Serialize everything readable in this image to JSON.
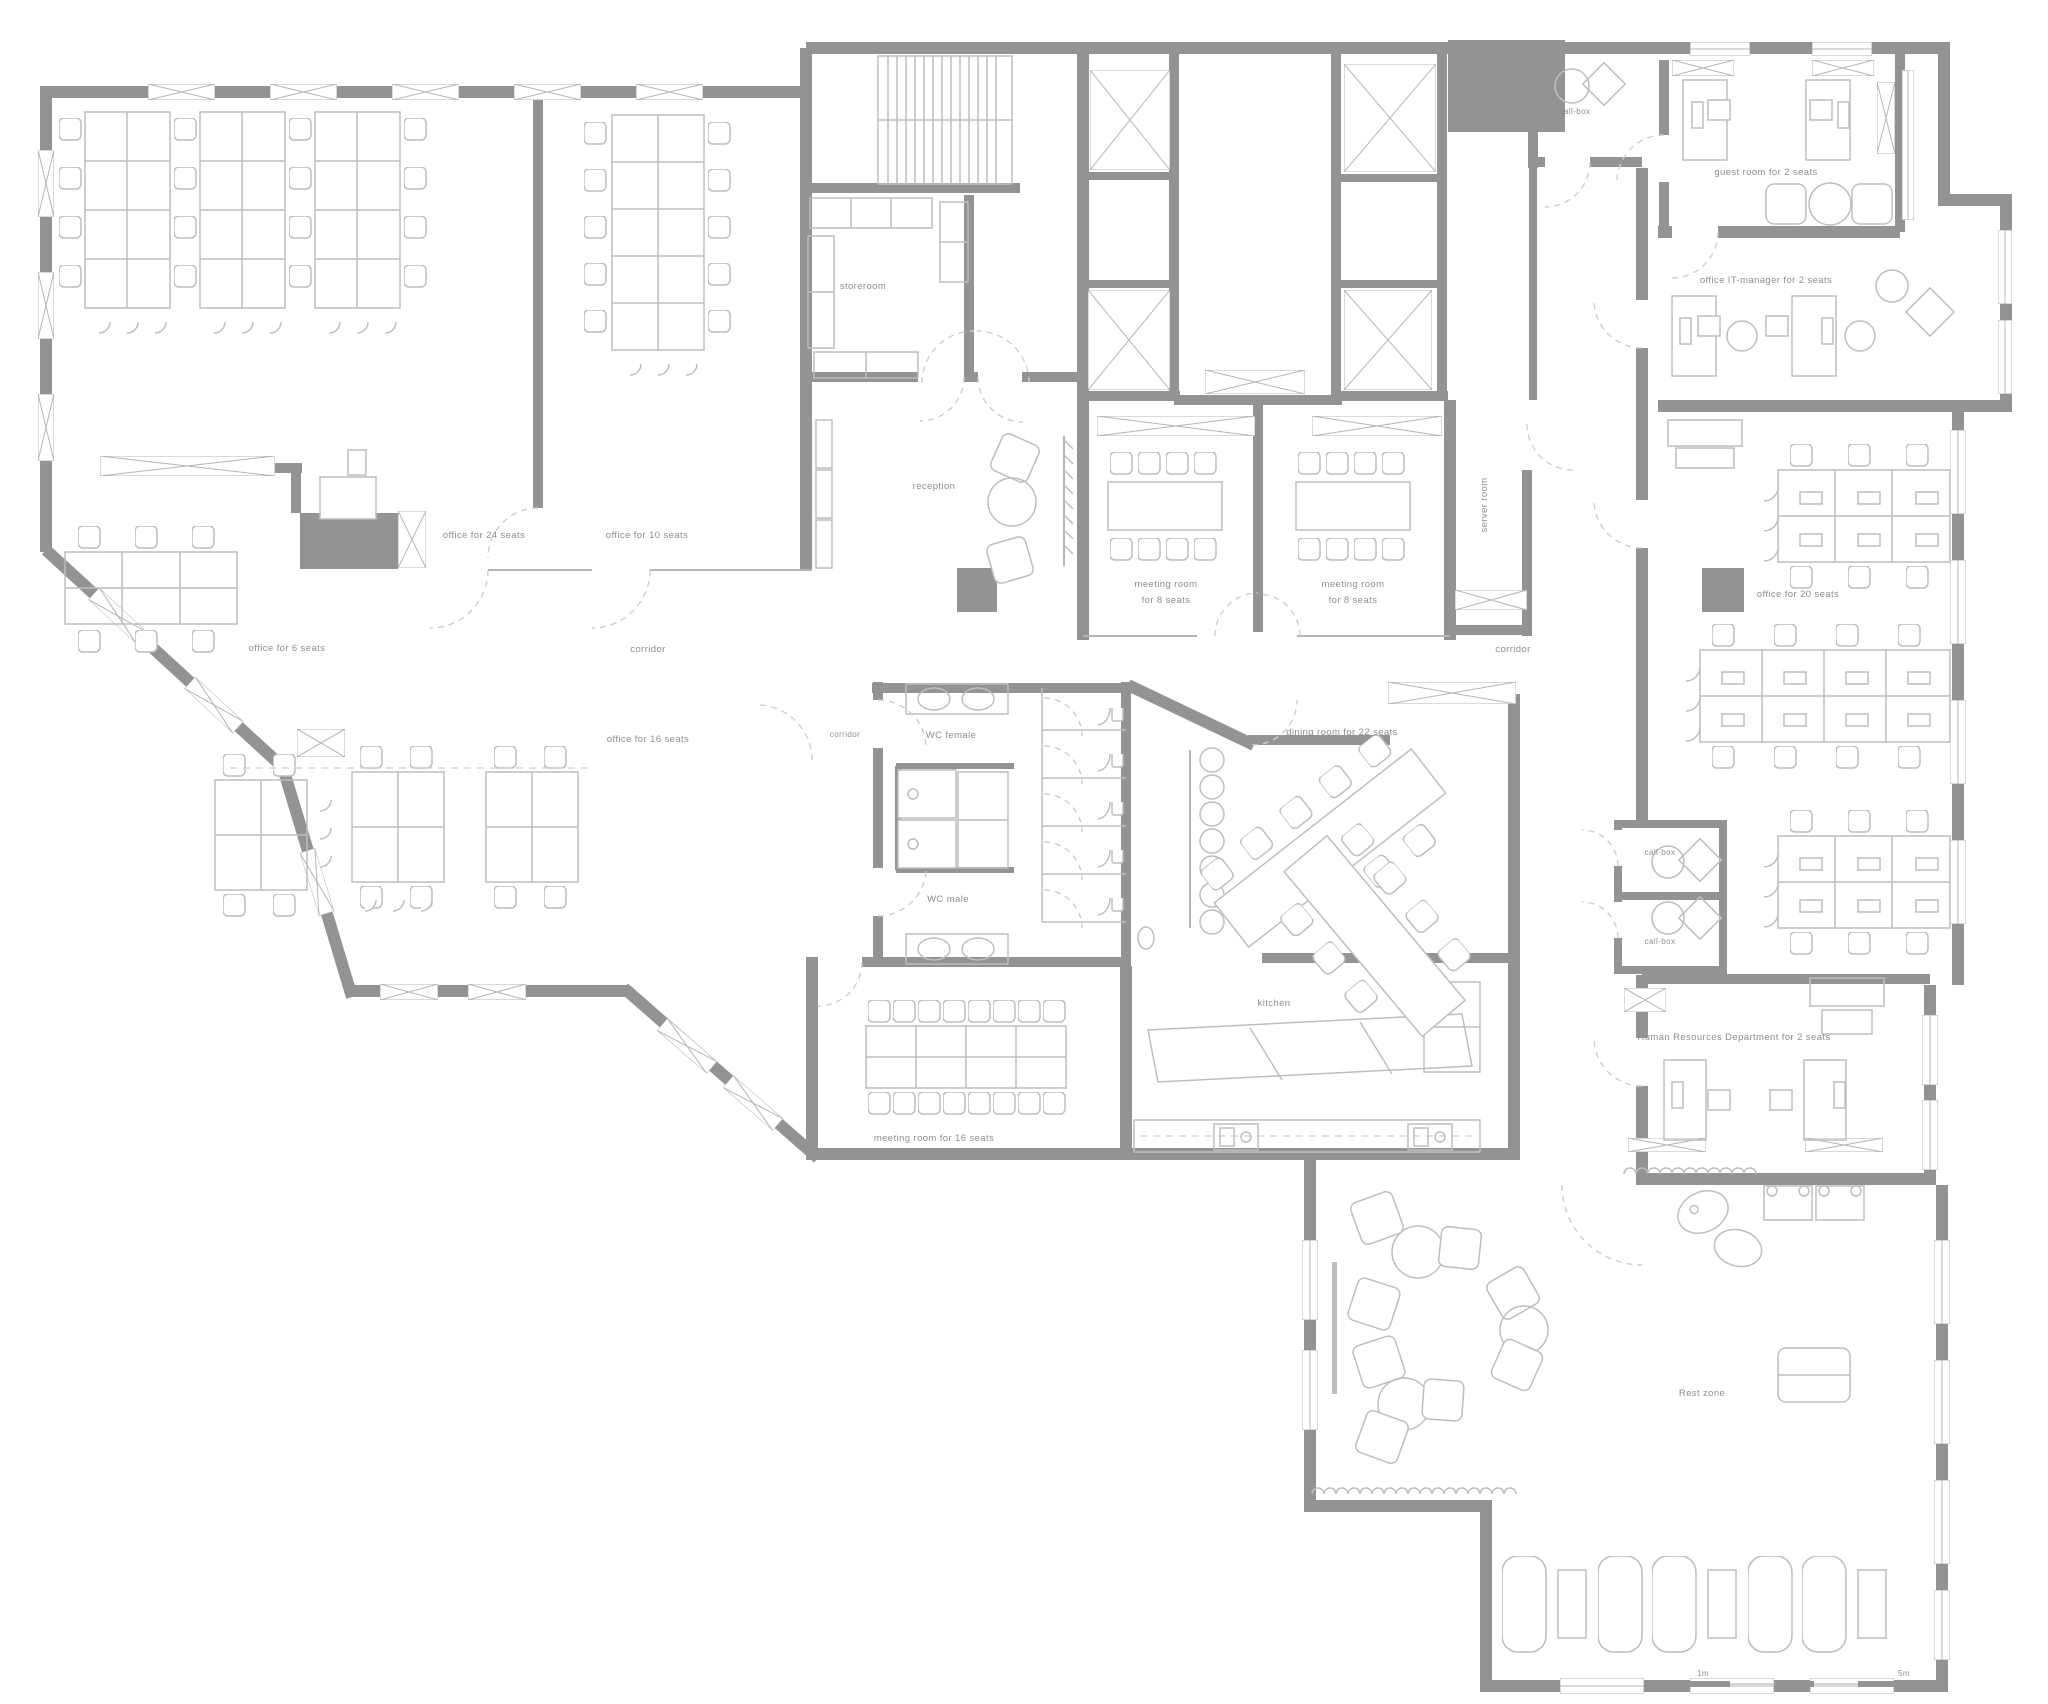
{
  "plan": {
    "type": "office floor plan",
    "colors": {
      "wall": "#939393",
      "furniture": "#bcbfbf",
      "label": "#8d8d8d"
    },
    "labels": {
      "office_24": "office for 24 seats",
      "office_10": "office for 10 seats",
      "office_6": "office for 6 seats",
      "office_16": "office for 16 seats",
      "office_20": "office for 20 seats",
      "corridor": "corridor",
      "storeroom": "storeroom",
      "reception": "reception",
      "meeting_8_line1": "meeting room",
      "meeting_8_line2": "for 8 seats",
      "meeting_16": "meeting room for 16 seats",
      "server_room": "server room",
      "call_box": "call-box",
      "guest_room": "guest room for 2 seats",
      "it_manager": "office IT-manager for 2 seats",
      "hr": "Human Resources Department for 2 seats",
      "dining": "dining room for 22 seats",
      "wc_female": "WC female",
      "wc_male": "WC male",
      "kitchen": "kitchen",
      "rest_zone": "Rest zone",
      "scale_1m": "1m",
      "scale_5m": "5m"
    }
  }
}
